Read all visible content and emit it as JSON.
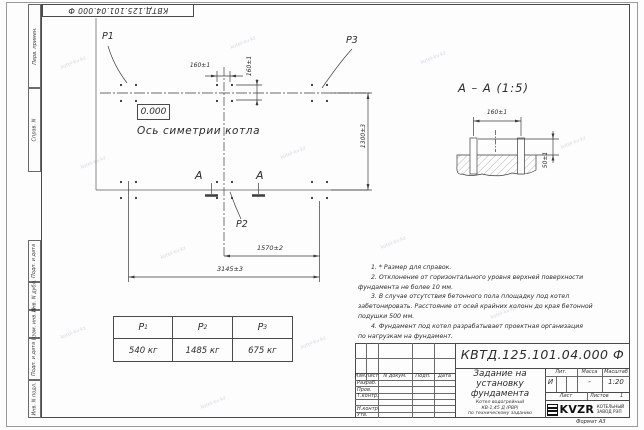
{
  "doc": {
    "stamp_rotated": "КВТД.125.101.04.000 Ф",
    "number_full": "КВТД.125.101.04.000  Ф",
    "format": "Формат А3"
  },
  "frame_fields": {
    "perv": "Перв. примен.",
    "sprav": "Справ. N",
    "podp1": "Подп. и дата",
    "inv_dubl": "Инв. N дубл.",
    "vzam": "Взам. инв. N",
    "podp2": "Подп. и дата",
    "inv_podl": "Инв. N подл."
  },
  "plan": {
    "elevation": "0.000",
    "axis_label": "Ось симетрии котла",
    "p1": "P1",
    "p2": "P2",
    "p3": "P3",
    "section_letter_left": "А",
    "section_letter_right": "А",
    "dims": {
      "d160h": "160±1",
      "d160v": "160±1",
      "d1300": "1300±3",
      "d1570": "1570±2",
      "d3145": "3145±3"
    }
  },
  "section": {
    "title": "А – А (1:5)",
    "d160": "160±1",
    "d50": "50±1"
  },
  "loads": {
    "headers": [
      {
        "b": "P",
        "s": "1"
      },
      {
        "b": "P",
        "s": "2"
      },
      {
        "b": "P",
        "s": "3"
      }
    ],
    "values": [
      "540 кг",
      "1485 кг",
      "675 кг"
    ]
  },
  "notes": {
    "lines": [
      "1. * Размер для справок.",
      "2. Отклонение от горизонтального уровня верхней поверхности",
      "фундамента не более 10 мм.",
      "3. В случае отсутствия бетонного пола площадку под котел",
      "забетонировать. Расстояние от осей крайних колонн до края бетонной",
      "подушки 500 мм.",
      "4. Фундамент под котел разрабатывает проектная организация",
      "по нагрузкам на фундамент."
    ]
  },
  "title_block": {
    "cols": {
      "izm": "Изм.",
      "list": "Лист",
      "doc": "N докум.",
      "podp": "Подп.",
      "data": "Дата"
    },
    "rows": {
      "razrab": "Разраб.",
      "prov": "Пров.",
      "tkontr": "Т.контр.",
      "nkontr": "Н.контр.",
      "utv": "Утв."
    },
    "title": "Задание на установку фундамента",
    "subtitle1": "Котел водогрейный",
    "subtitle2": "КВ-1,45 Д (РВР)",
    "subtitle3": "по техническому заданию",
    "lit_label": "Лит.",
    "massa_label": "Масса",
    "masshtab_label": "Масштаб",
    "lit_value": "И",
    "massa_value": "-",
    "masshtab_value": "1:20",
    "list_label": "Лист",
    "listov_label": "Листов",
    "listov_value": "1",
    "logo_text": "KVZR",
    "logo_caption1": "КОТЕЛЬНЫЙ",
    "logo_caption2": "ЗАВОД РЭП"
  },
  "watermark": {
    "text": "kotel-kv.kz"
  }
}
